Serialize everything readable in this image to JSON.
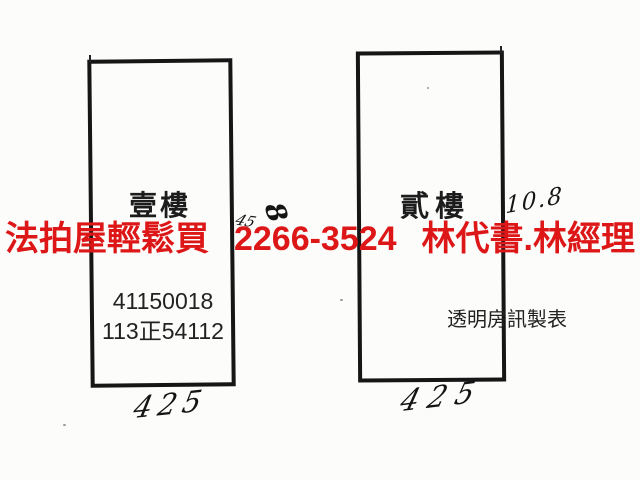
{
  "banner": {
    "slogan": "法拍屋輕鬆買",
    "phone": "2266-3524",
    "contact": "林代書.林經理",
    "color": "#dd1717"
  },
  "floor1": {
    "label": "壹樓",
    "id_line1": "41150018",
    "id_line2": "113正54112",
    "bottom_dimension": "425"
  },
  "floor2": {
    "label": "貳樓",
    "watermark": "透明房訊製表",
    "bottom_dimension": "425",
    "side_dimension": "10.8"
  },
  "mid_annotations": {
    "large_mark": "8",
    "small_mark": "45"
  }
}
